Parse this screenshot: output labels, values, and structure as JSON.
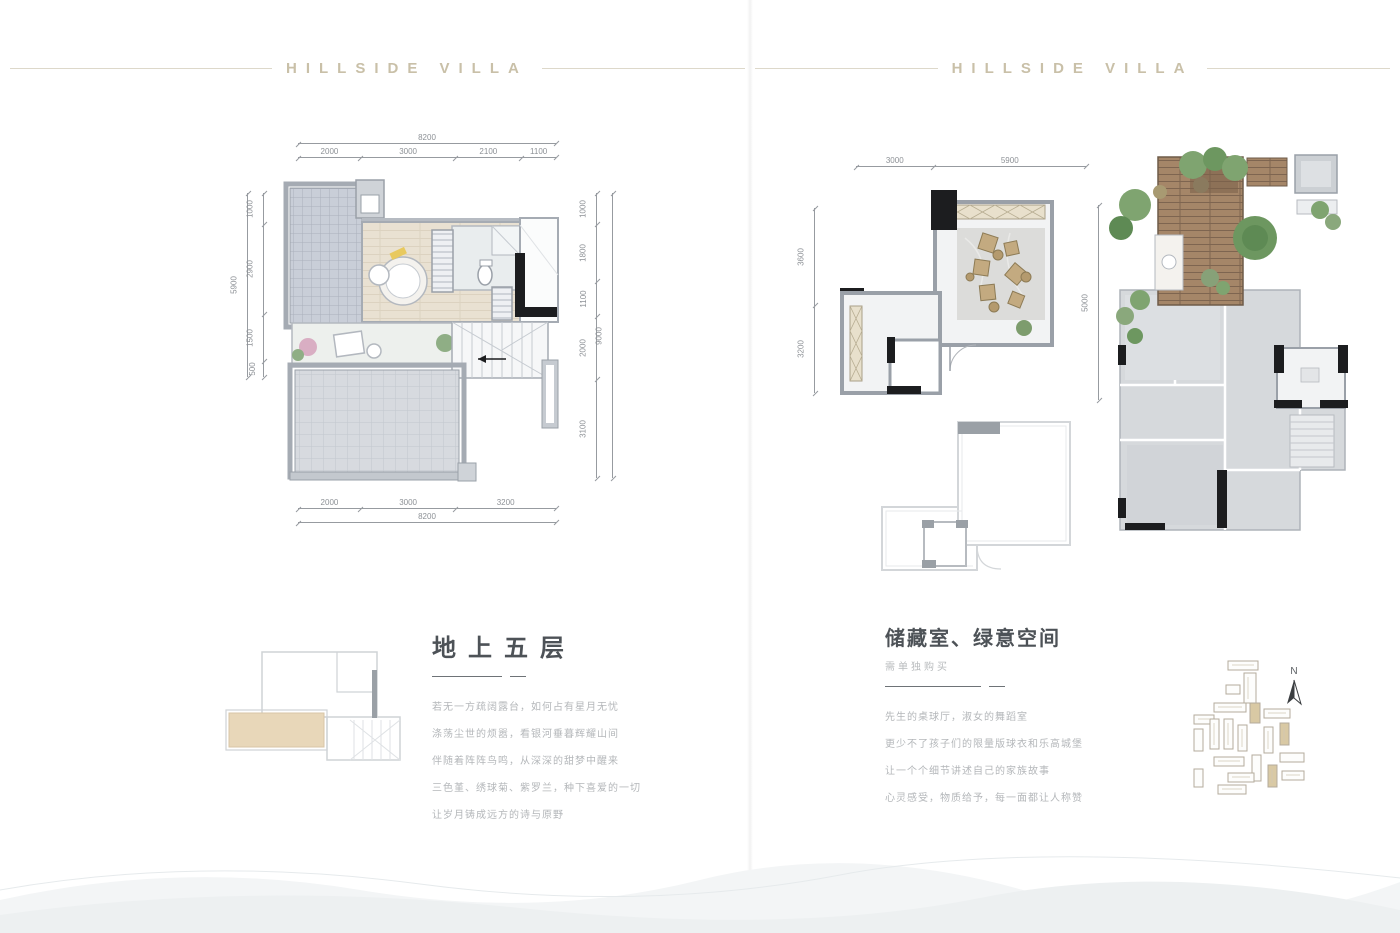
{
  "brand": "HILLSIDE VILLA",
  "colors": {
    "brand_text": "#c9c0a8",
    "rule_line": "#ddd8ca",
    "heading_text": "#4d5257",
    "subtitle_text": "#b8bbbd",
    "body_text": "#b4b7ba",
    "underline": "#6e7377",
    "dim_text": "#8d9196",
    "dim_line": "#979ba0",
    "wall_gray": "#a5abb3",
    "wall_black": "#1c1d1f",
    "tile_fill": "#c9ced8",
    "wood_deck": "#a58668",
    "wood_floor": "#e9e1d2",
    "terrace_highlight": "#e8d7b9",
    "plant_green": "#7fa470",
    "unit_gray": "#d6d9dc",
    "stone_floor": "#dcdcda",
    "furniture_tan": "#c3aa80"
  },
  "left_page": {
    "title": "地上五层",
    "body": [
      "若无一方疏阔露台，如何占有星月无忧",
      "涤荡尘世的烦嚣，看银河垂暮辉耀山间",
      "伴随着阵阵鸟鸣，从深深的甜梦中醒来",
      "三色堇、绣球菊、紫罗兰，种下喜爱的一切",
      "让岁月铸成远方的诗与原野"
    ]
  },
  "left_plan_dims": {
    "top_total": [
      "8200"
    ],
    "top": [
      "2000",
      "3000",
      "2100",
      "1100"
    ],
    "left_total": [
      "5900"
    ],
    "left": [
      "1000",
      "2900",
      "1500",
      "500"
    ],
    "right": [
      "1000",
      "1800",
      "1100",
      "2000",
      "3100"
    ],
    "right_total": [
      "9000"
    ],
    "bottom": [
      "2000",
      "3000",
      "3200"
    ],
    "bottom_total": [
      "8200"
    ]
  },
  "right_page": {
    "title": "储藏室、绿意空间",
    "subtitle": "需单独购买",
    "body": [
      "先生的桌球厅，淑女的舞蹈室",
      "更少不了孩子们的限量版球衣和乐高城堡",
      "让一个个细节讲述自己的家族故事",
      "心灵感受，物质给予，每一面都让人称赞"
    ],
    "north_label": "N"
  },
  "storage_plan_dims": {
    "top": [
      "3000",
      "5900"
    ],
    "left": [
      "3600",
      "3200"
    ],
    "right_total": [
      "5000"
    ]
  }
}
